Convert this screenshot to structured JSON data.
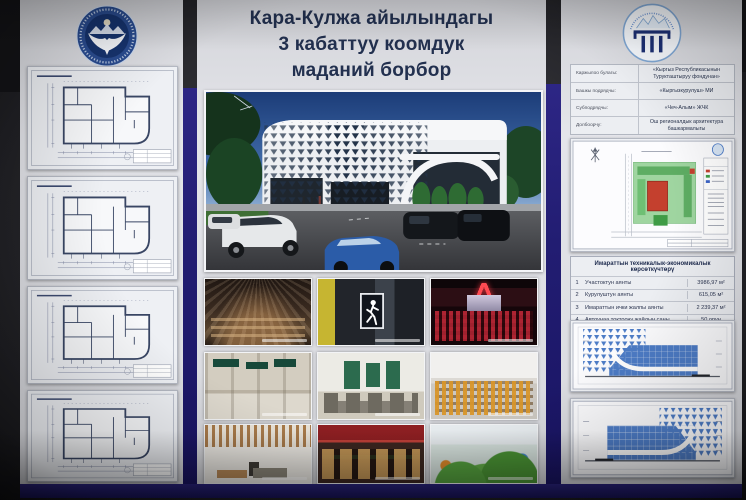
{
  "board": {
    "title_lines": [
      "Кара-Кулжа айылындагы",
      "3 кабаттуу коомдук",
      "маданий борбор"
    ]
  },
  "project_info": {
    "rows": [
      {
        "label": "Каржылоо булагы:",
        "value": "«Кыргыз Республикасынын Турукташтыруу фондунан»"
      },
      {
        "label": "Башкы подрядчы:",
        "value": "«Кыргызкурулуш» МИ"
      },
      {
        "label": "Субподрядчы:",
        "value": "«Чеч-Алым» ЖЧК"
      },
      {
        "label": "Долбоорчу:",
        "value": "Ош регионалдык архитектура башкармалыгы"
      }
    ]
  },
  "indicators": {
    "title": "Имараттын техникалык-экономикалык көрсөткүчтөрү",
    "rows": [
      {
        "num": "1",
        "label": "Участоктун аянты",
        "value": "3986,97 м²"
      },
      {
        "num": "2",
        "label": "Курулуштун аянты",
        "value": "615,05 м²"
      },
      {
        "num": "3",
        "label": "Имараттын ички жалпы аянты",
        "value": "2 239,37 м²"
      },
      {
        "num": "4",
        "label": "Автоунаа токтоочу жайдын саны",
        "value": "50 орун"
      }
    ]
  },
  "icons": {
    "left_logo": "kyrgyz-republic-emblem",
    "right_logo": "state-architecture-agency-logo",
    "north_arrow": "north-arrow"
  },
  "colors": {
    "divider_navy": "#221d72",
    "poster_white": "#dfe0e6",
    "title_text": "#22304f",
    "facade_blue": "#4d7cc6",
    "site_building_red": "#c4402e",
    "landscape_green": "#57a85c"
  }
}
